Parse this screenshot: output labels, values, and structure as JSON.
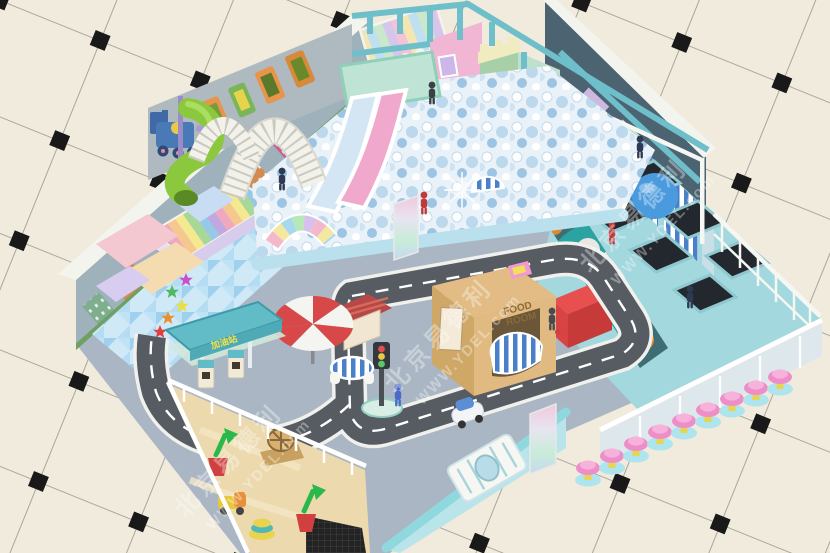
{
  "scene_title": "indoor-playground-3d-render",
  "watermark": {
    "brand_cn": "北京易德利",
    "url": "WWW.YDEL.com"
  },
  "signs": {
    "gas_station": "加油站",
    "food_house_line1": "FOOD",
    "food_house_line2": "ROOM"
  },
  "areas": [
    "ball-pit",
    "wave-slides",
    "spiral-tube-slide",
    "net-crawl-arches",
    "toddler-soft-play-zone",
    "trampoline-park",
    "sand-pit",
    "toy-road-circuit",
    "gas-station-playset",
    "market-stalls",
    "food-playhouse",
    "castle-tower",
    "two-story-playhouse",
    "train-wall-decor",
    "city-skyline-mural",
    "mushroom-stool-row",
    "entrance-balustrade",
    "bear-face-partition"
  ],
  "colors": {
    "tile": "#f0ebdc",
    "tileline": "#98948a",
    "diamond": "#191919",
    "walldark": "#4c6372",
    "cap": "#f4f4ef",
    "muralsky": "#9fb2bc",
    "floor": "#aab6c3",
    "road": "#575c63",
    "roadedge": "#f0f0ec",
    "ballbase": "#eaf2f9",
    "pitwall": "#b9e0ec",
    "slidepink": "#f0a8cc",
    "slideblue": "#d4e6f4",
    "spiral": "#8cc83e",
    "frame": "#6fbfca",
    "toddler": "#cfe9f7",
    "sand": "#ecd9ae",
    "tramp": "#a2d8de",
    "trampbed": "#23282e",
    "bigball": "#4a9ade",
    "partition": "#3f6d74",
    "face": "#2ba3a3",
    "bench": "#e85050",
    "stool": "#ee8ec8",
    "canopy": "#62bcc8",
    "wood": "#d9b078",
    "umbred": "#d84848",
    "balustrade": "#b8e4ea"
  }
}
